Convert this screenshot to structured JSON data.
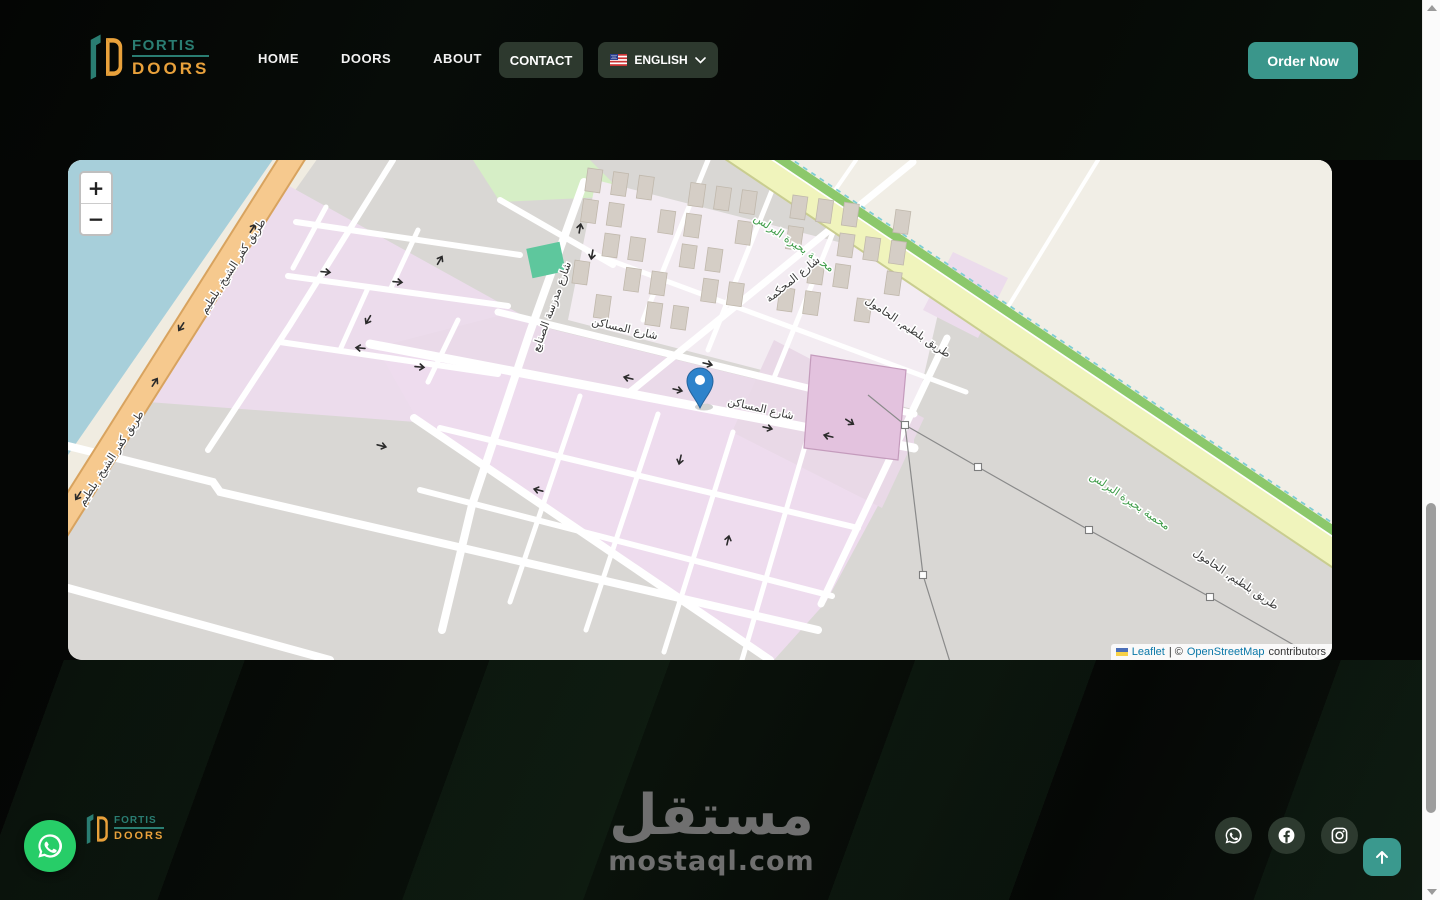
{
  "brand": {
    "fortis": "FORTIS",
    "doors": "DOORS"
  },
  "header": {
    "nav": [
      {
        "label": "HOME"
      },
      {
        "label": "DOORS"
      },
      {
        "label": "ABOUT"
      }
    ],
    "contact_label": "CONTACT",
    "language_label": "ENGLISH",
    "order_label": "Order Now"
  },
  "map": {
    "zoom_in_label": "+",
    "zoom_out_label": "−",
    "attribution": {
      "leaflet": "Leaflet",
      "divider": "| ©",
      "osm": "OpenStreetMap",
      "contributors": "contributors"
    },
    "labels": {
      "kafr_road": "طريق كفر الشيخ, بلطيم",
      "baltim_road": "طريق بلطيم, الحامول",
      "protected_area": "محمية بحيرة البرلس",
      "masaken_street": "شارع المساكن",
      "mahkama_street": "شارع المحكمة",
      "sanaye_street": "شارع مدرسة الصنايع"
    }
  },
  "footer": {
    "watermark_ar": "مستقل",
    "watermark_en": "mostaql.com"
  },
  "colors": {
    "accent_teal": "#3a968b",
    "pill_green": "#2d392e",
    "logo_teal": "#2a7d72",
    "logo_orange": "#e9a13b",
    "whatsapp_green": "#27cd68",
    "map_water": "#a7cfda",
    "map_pink": "#ecdcec",
    "map_orange_road": "#f6c98e",
    "map_yellow_road": "#f0f4bc",
    "map_green_strip": "#8cc86b",
    "link_blue": "#0a78a8",
    "marker_blue": "#2e83cb"
  }
}
